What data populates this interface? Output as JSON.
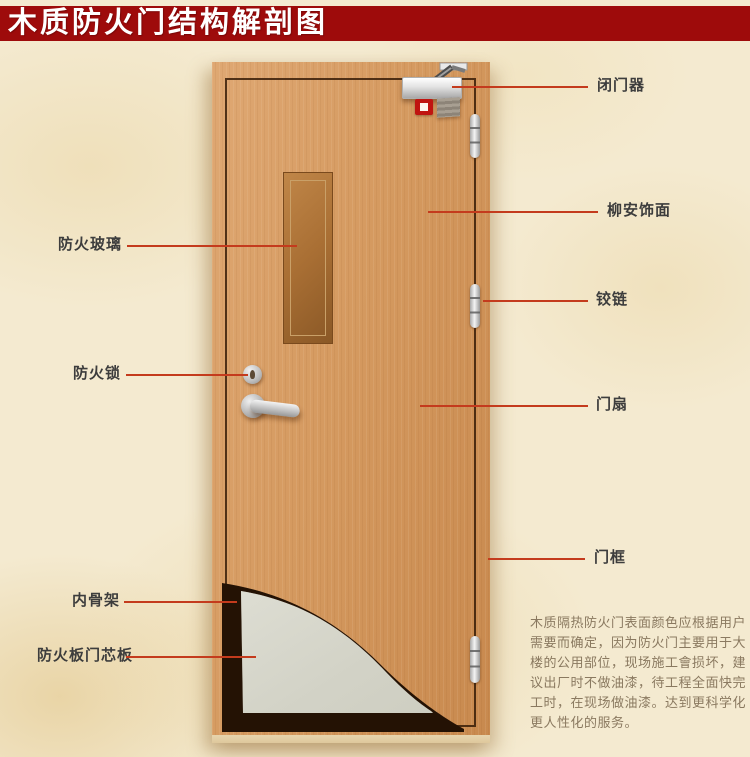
{
  "title": "木质防火门结构解剖图",
  "callouts": {
    "right": [
      "闭门器",
      "柳安饰面",
      "铰链",
      "门扇",
      "门框"
    ],
    "left": [
      "防火玻璃",
      "防火锁",
      "内骨架",
      "防火板门芯板"
    ]
  },
  "note": {
    "lines": [
      "木质隔热防火门表面颜色应根据用户",
      "需要而确定，因为防火门主要用于大",
      "楼的公用部位，现场施工會损坏，建",
      "议出厂时不做油漆，待工程全面快完",
      "工时，在现场做油漆。达到更科学化",
      "更人性化的服务。"
    ]
  },
  "colors": {
    "banner_red": "#9e0b0b",
    "callout_line_red": "#c43b1d",
    "background_beige": "#f4ead0",
    "door_wood": "#d59a60",
    "core_panel_grey": "#d6d6cb",
    "skeleton_dark": "#241204"
  }
}
